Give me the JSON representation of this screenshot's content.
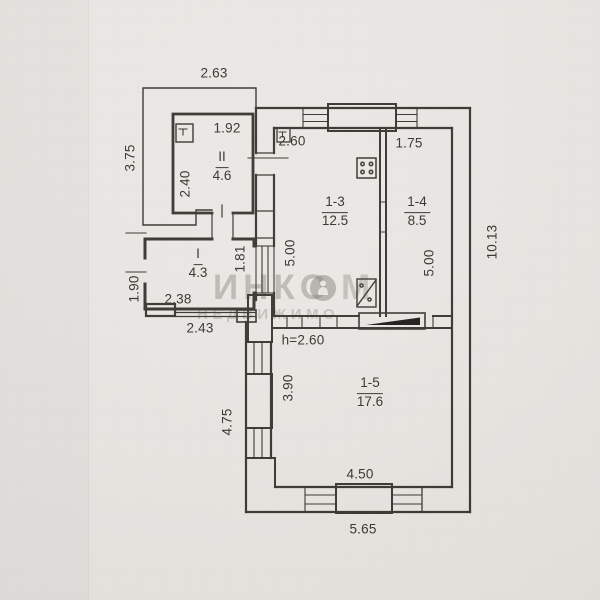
{
  "watermark": {
    "line1": "ИНКО",
    "line1_suffix": "М",
    "line2": "НЕДВИЖИМО"
  },
  "plan": {
    "rooms": {
      "r2": {
        "number": "II",
        "area": "4.6"
      },
      "r1": {
        "number": "I",
        "area": "4.3"
      },
      "r13": {
        "number": "1-3",
        "area": "12.5"
      },
      "r14": {
        "number": "1-4",
        "area": "8.5"
      },
      "r15": {
        "number": "1-5",
        "area": "17.6"
      }
    },
    "ceiling_height": "h=2.60",
    "dimensions": {
      "annex_top": "2.63",
      "annex_west": "3.75",
      "room2_width": "1.92",
      "room2_depth": "2.40",
      "room13_top_width": "2.60",
      "room14_top_width": "1.75",
      "east_wall": "10.13",
      "room13_depth": "5.00",
      "room14_depth": "5.00",
      "hall_right": "1.81",
      "west_offset": "1.90",
      "hall_width": "2.38",
      "hall_bottom": "2.43",
      "room15_west_inner": "3.90",
      "room15_west_outer": "4.75",
      "room15_bottom_inner": "4.50",
      "south_wall": "5.65"
    }
  }
}
